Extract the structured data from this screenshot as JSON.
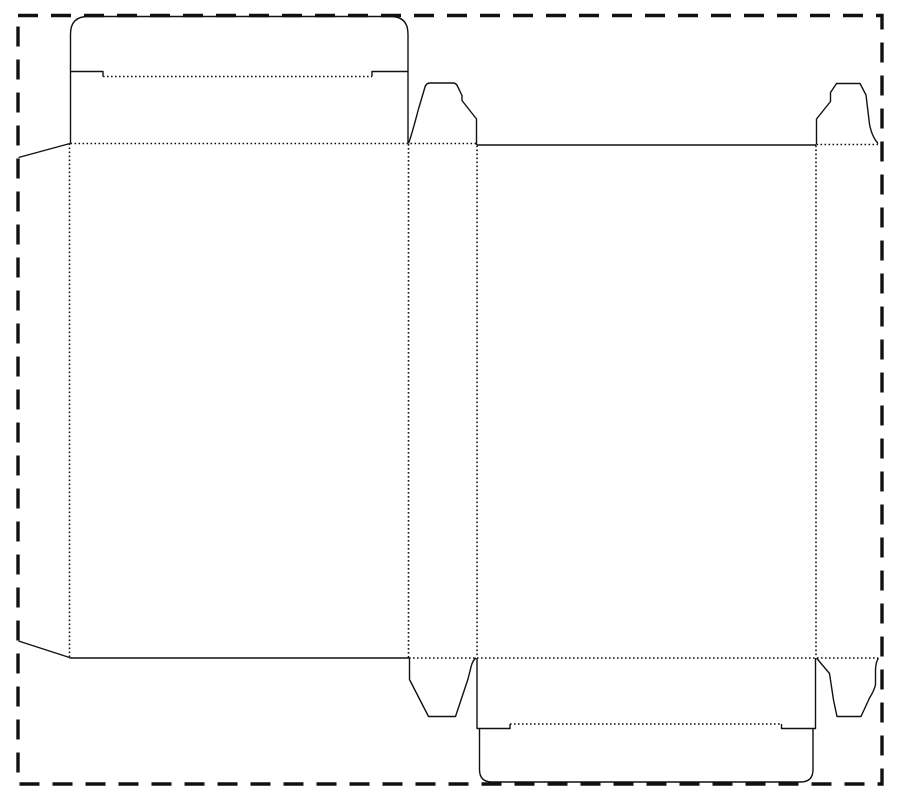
{
  "page": {
    "title": "Folding carton dieline template",
    "background": "#ffffff"
  },
  "canvas": {
    "width": 900,
    "height": 800
  },
  "colors": {
    "line": "#111111",
    "background": "#ffffff"
  },
  "line_styles": {
    "border": {
      "stroke_width": 3.4,
      "dash": "20 13"
    },
    "cut": {
      "stroke_width": 1.4,
      "dash": ""
    },
    "fold": {
      "stroke_width": 1.6,
      "dash": "1.6 2.4"
    }
  },
  "dieline": {
    "description": "Straight tuck end carton blank: glue flap, front panel with tuck lid, two side panels with dust flaps, back panel with bottom tuck lid",
    "border": {
      "name": "sheet-border",
      "kind": "border",
      "d": "M 18,15.5 L 882,15.5 L 882,784 L 18,784 Z"
    },
    "paths": [
      {
        "name": "glue-flap-top-edge",
        "kind": "cut",
        "d": "M 18.5,157.5 L 70,143.5"
      },
      {
        "name": "glue-flap-bottom-edge",
        "kind": "cut",
        "d": "M 18.5,641 L 69.5,657.5"
      },
      {
        "name": "front-panel-bottom-edge",
        "kind": "cut",
        "d": "M 69.5,658 L 409,658"
      },
      {
        "name": "top-closure-left-edge",
        "kind": "cut",
        "d": "M 70.5,143.5 L 70.5,71.5"
      },
      {
        "name": "top-tuck-shoulder-left",
        "kind": "cut",
        "d": "M 70.5,71.5 L 103,71.5 L 103,76.5"
      },
      {
        "name": "top-tuck-lid-outline",
        "kind": "cut",
        "d": "M 70.5,71.5 L 70.5,34 Q 70.5,16.5 88,16.5 L 390.5,16.5 Q 408,16.5 408,34 L 408,143.5"
      },
      {
        "name": "top-tuck-shoulder-right",
        "kind": "cut",
        "d": "M 372,76.5 L 372,71.5 L 408,71.5"
      },
      {
        "name": "top-dust-flap-left",
        "kind": "cut",
        "d": "M 408.5,143.5 C 412,134 415,122 418.5,109 L 425,87 Q 426.2,83 430.2,83 L 453,83 Q 456.2,83 457.5,86.2 L 462,95.5 L 462,100.5 L 476.5,119 L 476.5,145"
      },
      {
        "name": "back-panel-top-edge",
        "kind": "cut",
        "d": "M 477,145 L 816,145"
      },
      {
        "name": "top-dust-flap-right",
        "kind": "cut",
        "d": "M 816.5,144.5 L 816.5,119 L 830.5,101.5 L 830.5,92.5 L 836.5,83.5 L 860,83.5 L 866,95 L 869.5,124 Q 871.5,136 878,143.5"
      },
      {
        "name": "bottom-dust-flap-left",
        "kind": "cut",
        "d": "M 409.5,658 L 409.5,679.5 L 428.5,716.5 L 455.5,716.5 L 468,679 L 471,667 Q 472.5,660.5 476,658"
      },
      {
        "name": "bottom-closure-left-cut",
        "kind": "cut",
        "d": "M 477,658 L 477,728.5 L 510,728.5 L 510,724"
      },
      {
        "name": "bottom-closure-right-cut",
        "kind": "cut",
        "d": "M 815.5,658 L 815.5,728.5 L 781.5,728.5 L 781.5,724"
      },
      {
        "name": "bottom-tuck-lid-outline",
        "kind": "cut",
        "d": "M 479.5,728.5 L 479.5,769.5 Q 479.5,782 492,782 L 800.5,782 Q 813,782 813,769.5 L 813,728.5"
      },
      {
        "name": "bottom-dust-flap-right",
        "kind": "cut",
        "d": "M 816.5,658 L 829.5,673.5 L 833.5,700 L 837,716.5 L 861,716.5 L 869.5,698 Q 874.5,690 875.5,684.5 L 875.5,669 Q 876,661.5 878.5,658"
      },
      {
        "name": "fold-glue-flap",
        "kind": "fold",
        "d": "M 69.5,143.5 L 69.5,657.5"
      },
      {
        "name": "fold-front-to-side",
        "kind": "fold",
        "d": "M 408.5,144 L 408.5,657.5"
      },
      {
        "name": "fold-side-to-back",
        "kind": "fold",
        "d": "M 477,145.5 L 477,657.5"
      },
      {
        "name": "fold-back-to-side",
        "kind": "fold",
        "d": "M 816,145.5 L 816,657"
      },
      {
        "name": "fold-top-closure",
        "kind": "fold",
        "d": "M 70.5,143.5 L 477,143.5"
      },
      {
        "name": "fold-top-dust-flap-right",
        "kind": "fold",
        "d": "M 816.5,144.5 L 878,144.5"
      },
      {
        "name": "fold-bottom-closure",
        "kind": "fold",
        "d": "M 409,658 L 878,658"
      },
      {
        "name": "fold-top-tuck-lid",
        "kind": "fold",
        "d": "M 103,76.5 L 372,76.5"
      },
      {
        "name": "fold-bottom-tuck-lid",
        "kind": "fold",
        "d": "M 510,724 L 781.5,724"
      }
    ]
  }
}
